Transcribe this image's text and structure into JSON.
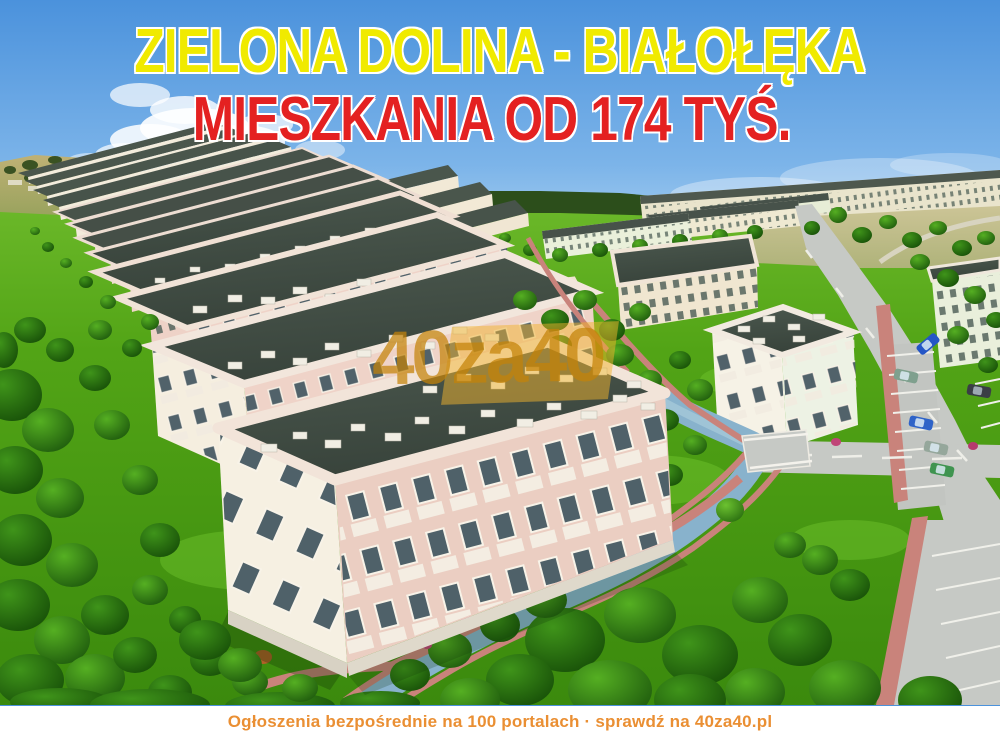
{
  "page": {
    "width": 1000,
    "height": 737,
    "kind": "real-estate advertisement"
  },
  "headline": {
    "line1": "ZIELONA DOLINA - BIAŁOŁĘKA",
    "line1_color": "#F0EA00",
    "line2": "MIESZKANIA OD 174 TYŚ.",
    "line2_color": "#E42121",
    "outline_color": "#FFFFFF"
  },
  "watermark": {
    "text": "40za40",
    "color": "#C48208"
  },
  "footer": {
    "text": "Ogłoszenia bezpośrednie na 100 portalach · sprawdź na 40za40.pl",
    "text_color": "#EA8F33",
    "background": "#FFFFFF"
  },
  "scene": {
    "type": "aerial-3d-render",
    "subject": "housing estate with rows of apartment blocks, lawns, trees, roads, parking and a canal",
    "sky_top_color": "#4B92DC",
    "sky_horizon_color": "#C9E4F6",
    "grass_color": "#4C9F13",
    "roof_color": "#3E4A42",
    "facade_color": "#F4EEE0",
    "facade_shadow_color": "#EBCEC2",
    "road_color": "#C6C9C5",
    "path_color": "#C9837B",
    "canal_color": "#88B2CC",
    "car_colors": [
      "#2456C6",
      "#7FA08E",
      "#3A3E45",
      "#2E63C8",
      "#95A79B",
      "#3F9450"
    ]
  }
}
